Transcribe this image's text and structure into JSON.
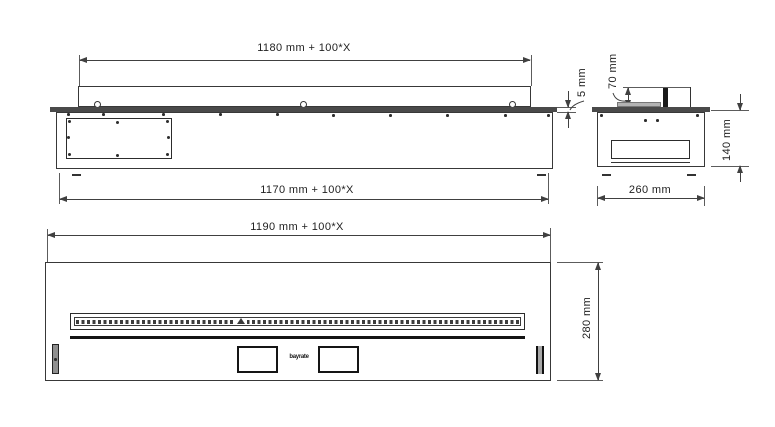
{
  "drawing": {
    "unit": "mm",
    "colors": {
      "background": "#ffffff",
      "line": "#383838",
      "flange_fill": "#4a4a4a",
      "burner_plate_fill": "#b3b3b3"
    },
    "side_view": {
      "dim_top_length": "1180 mm + 100*X",
      "dim_bottom_length": "1170 mm + 100*X",
      "dim_flange_thickness": "5 mm"
    },
    "end_view": {
      "dim_burner_height": "70 mm",
      "dim_body_height": "140 mm",
      "dim_body_width": "260 mm"
    },
    "plan_view": {
      "dim_overall_length": "1190 mm + 100*X",
      "dim_overall_depth": "280 mm",
      "logo_text": "bayrate"
    }
  }
}
